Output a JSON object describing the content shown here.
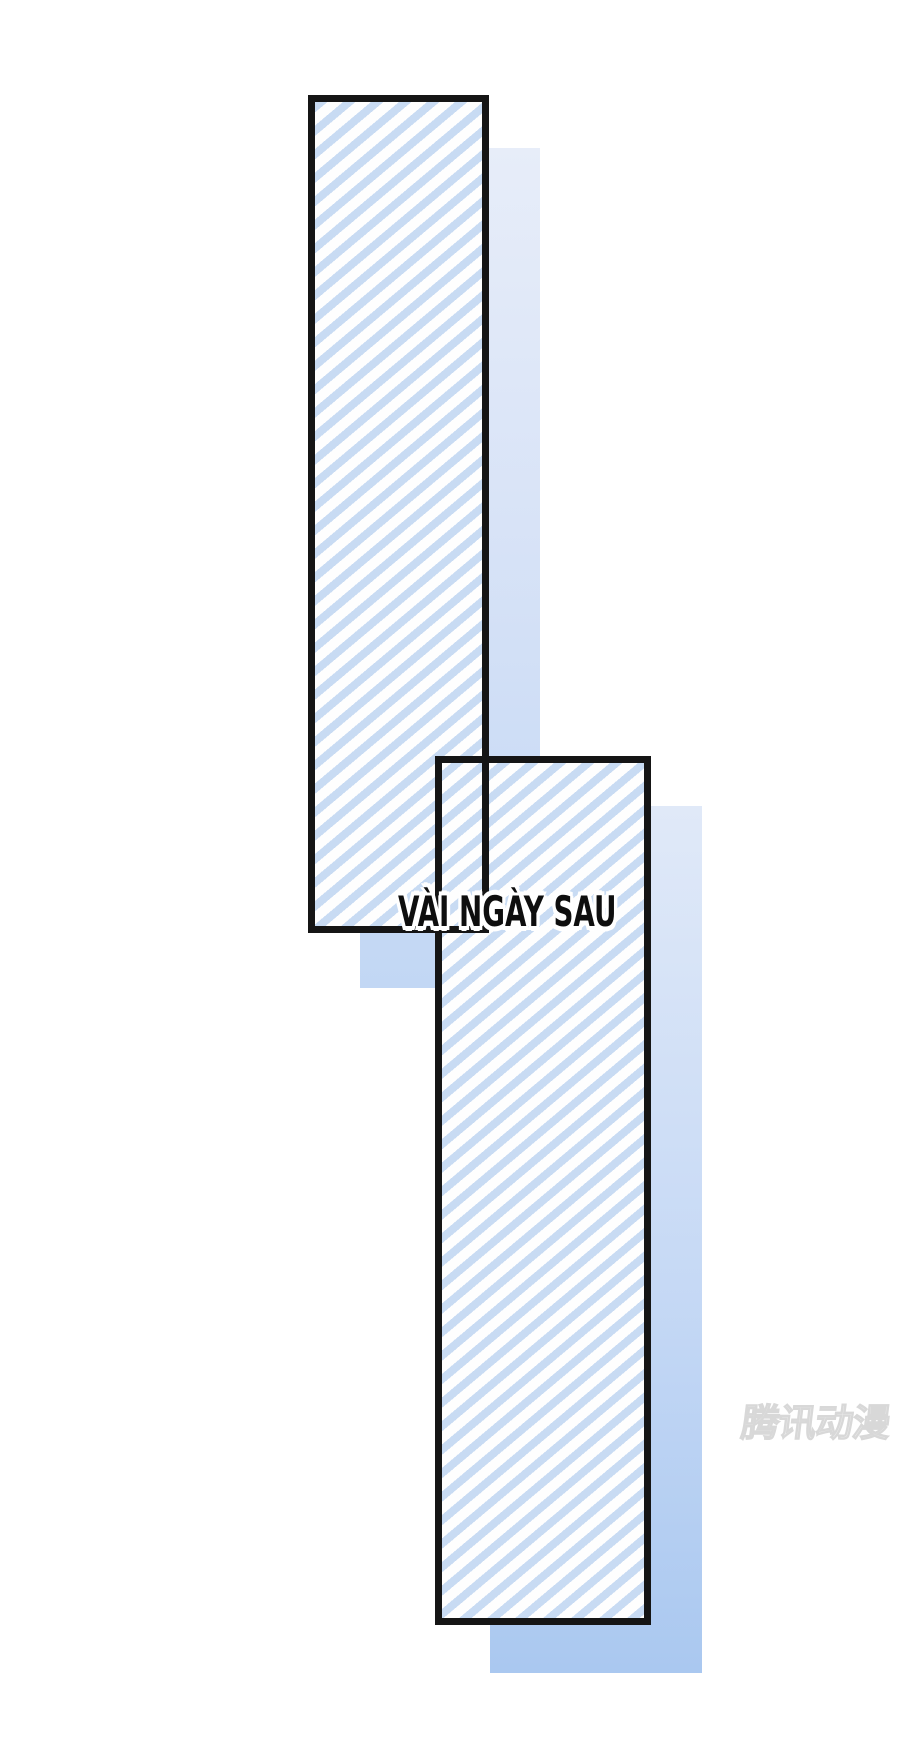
{
  "page": {
    "kind": "comic-transition-page",
    "width": 900,
    "height": 1752
  },
  "caption": {
    "text": "VÀI NGÀY SAU"
  },
  "watermark": {
    "text": "腾讯动漫"
  },
  "panels": [
    {
      "name": "striped-panel-top"
    },
    {
      "name": "striped-panel-bottom"
    }
  ],
  "colors": {
    "page-bg": "#ffffff",
    "stripe-blue": "#c8dbf3",
    "stripe-bg": "#fefefe",
    "frame-border": "#151515",
    "shadow1-top": "#e7edf9",
    "shadow1-bottom": "#c2d7f4",
    "shadow2-top": "#e0e9f8",
    "shadow2-bottom": "#aac8f0",
    "caption-text": "#0e0e0e",
    "caption-outline": "#ffffff",
    "watermark-gray": "#d4d4d4"
  }
}
